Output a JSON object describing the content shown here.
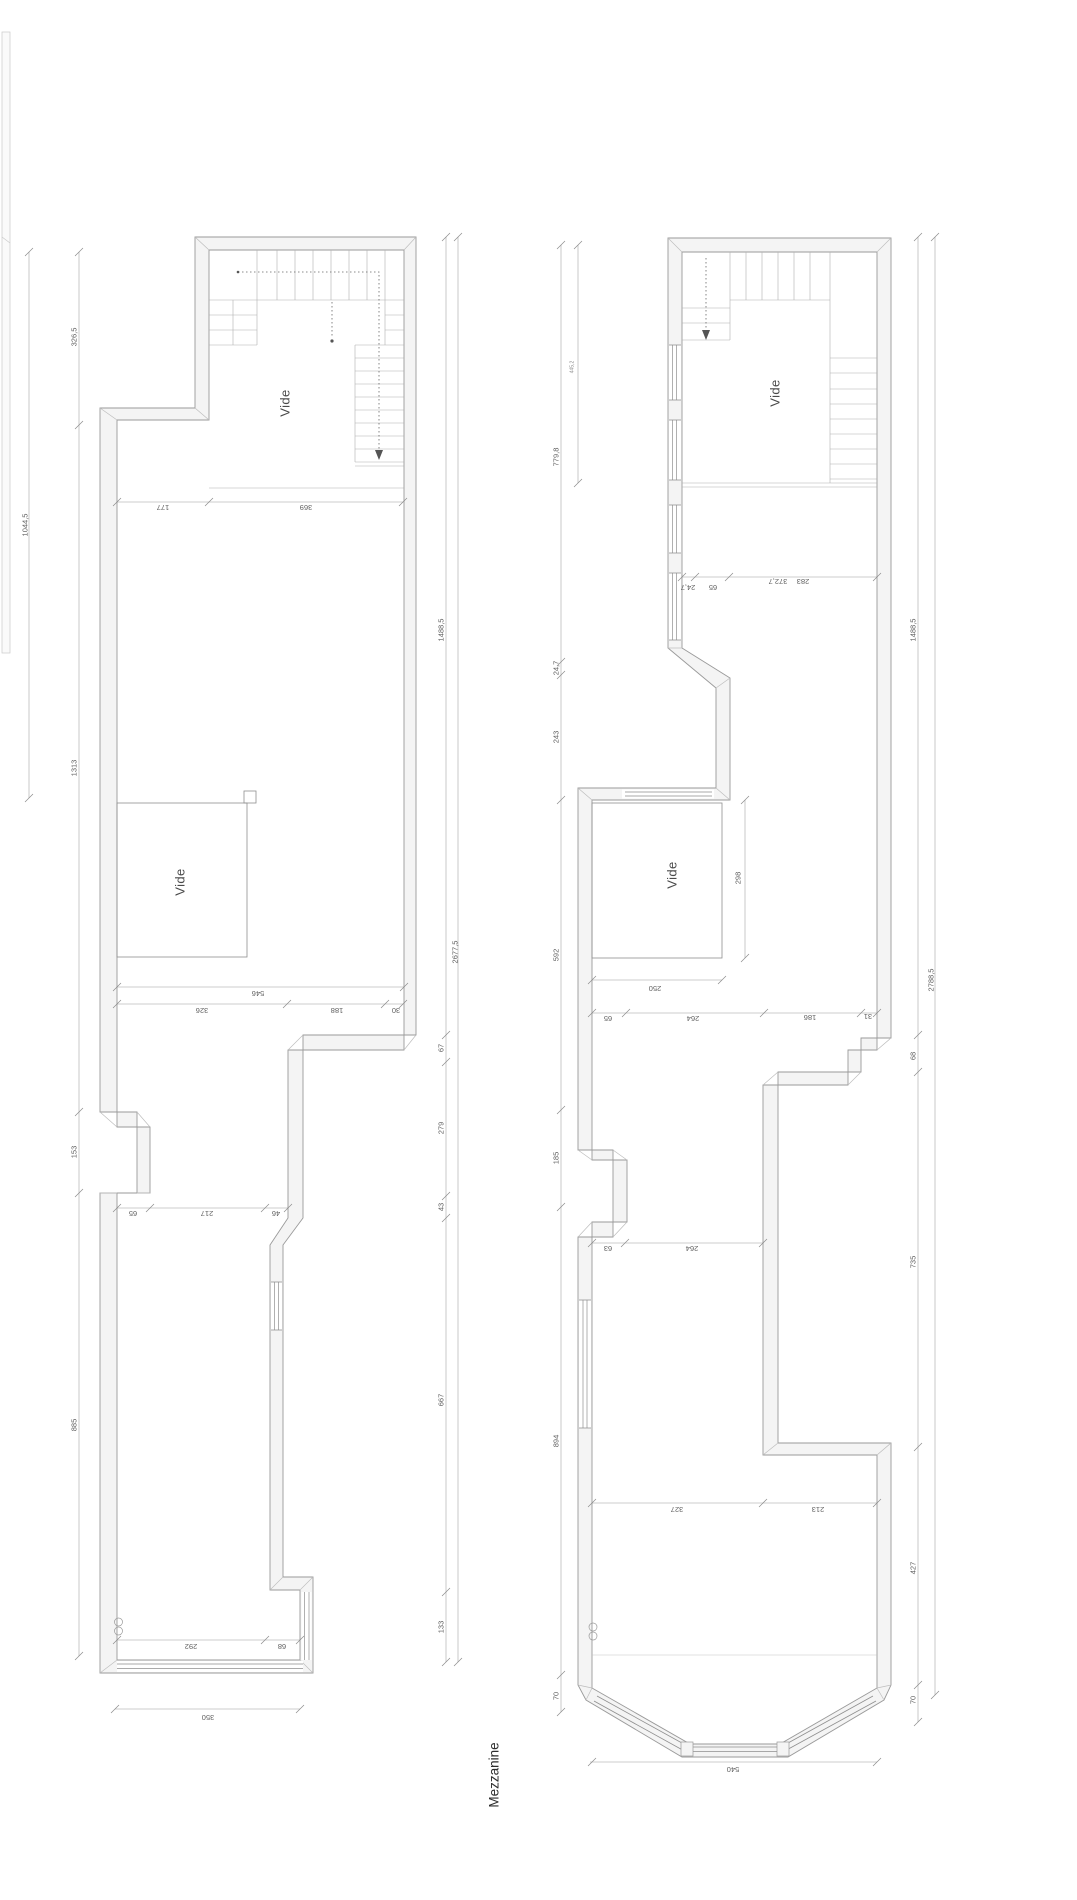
{
  "title": {
    "text": "Mezzanine",
    "x": 494,
    "y": 1775
  },
  "colors": {
    "background": "#ffffff",
    "wall_fill": "#f4f4f4",
    "wall_line": "#9a9a9a",
    "thin_line": "#b0b0b0",
    "dim_line": "#999999",
    "text": "#5f5f5f"
  },
  "plans": [
    {
      "name": "left-plan",
      "room_labels": [
        {
          "text": "Vide",
          "x": 285,
          "y": 403
        },
        {
          "text": "Vide",
          "x": 180,
          "y": 882
        }
      ],
      "dim_labels_vertical": [
        {
          "text": "326,5",
          "x": 74,
          "y": 337
        },
        {
          "text": "1044,5",
          "x": 25,
          "y": 525
        },
        {
          "text": "1313",
          "x": 74,
          "y": 768
        },
        {
          "text": "153",
          "x": 74,
          "y": 1152
        },
        {
          "text": "885",
          "x": 74,
          "y": 1425
        },
        {
          "text": "1488,5",
          "x": 441,
          "y": 630
        },
        {
          "text": "2677,5",
          "x": 455,
          "y": 952
        },
        {
          "text": "67",
          "x": 441,
          "y": 1048
        },
        {
          "text": "279",
          "x": 441,
          "y": 1128
        },
        {
          "text": "43",
          "x": 441,
          "y": 1207
        },
        {
          "text": "667",
          "x": 441,
          "y": 1400
        },
        {
          "text": "133",
          "x": 441,
          "y": 1627
        }
      ],
      "dim_labels_horizontal": [
        {
          "text": "177",
          "x": 163,
          "y": 507
        },
        {
          "text": "369",
          "x": 306,
          "y": 507
        },
        {
          "text": "546",
          "x": 258,
          "y": 993
        },
        {
          "text": "326",
          "x": 202,
          "y": 1010
        },
        {
          "text": "188",
          "x": 337,
          "y": 1010
        },
        {
          "text": "30",
          "x": 396,
          "y": 1010
        },
        {
          "text": "65",
          "x": 133,
          "y": 1213
        },
        {
          "text": "217",
          "x": 207,
          "y": 1213
        },
        {
          "text": "46",
          "x": 276,
          "y": 1213
        },
        {
          "text": "292",
          "x": 191,
          "y": 1646
        },
        {
          "text": "68",
          "x": 282,
          "y": 1646
        },
        {
          "text": "350",
          "x": 208,
          "y": 1717
        }
      ],
      "tiny_labels": []
    },
    {
      "name": "right-plan",
      "room_labels": [
        {
          "text": "Vide",
          "x": 775,
          "y": 393
        },
        {
          "text": "Vide",
          "x": 672,
          "y": 875
        }
      ],
      "dim_labels_vertical": [
        {
          "text": "779,8",
          "x": 556,
          "y": 457
        },
        {
          "text": "24,7",
          "x": 556,
          "y": 668
        },
        {
          "text": "243",
          "x": 556,
          "y": 737
        },
        {
          "text": "592",
          "x": 556,
          "y": 955
        },
        {
          "text": "185",
          "x": 556,
          "y": 1158
        },
        {
          "text": "894",
          "x": 556,
          "y": 1441
        },
        {
          "text": "70",
          "x": 556,
          "y": 1696
        },
        {
          "text": "1488,5",
          "x": 913,
          "y": 630
        },
        {
          "text": "2788,5",
          "x": 931,
          "y": 980
        },
        {
          "text": "68",
          "x": 913,
          "y": 1056
        },
        {
          "text": "735",
          "x": 913,
          "y": 1262
        },
        {
          "text": "427",
          "x": 913,
          "y": 1568
        },
        {
          "text": "70",
          "x": 913,
          "y": 1700
        },
        {
          "text": "298",
          "x": 738,
          "y": 878
        }
      ],
      "dim_labels_horizontal": [
        {
          "text": "24,7",
          "x": 688,
          "y": 587
        },
        {
          "text": "65",
          "x": 713,
          "y": 587
        },
        {
          "text": "372,7",
          "x": 778,
          "y": 581
        },
        {
          "text": "283",
          "x": 803,
          "y": 581
        },
        {
          "text": "250",
          "x": 655,
          "y": 988
        },
        {
          "text": "65",
          "x": 608,
          "y": 1018
        },
        {
          "text": "264",
          "x": 693,
          "y": 1018
        },
        {
          "text": "186",
          "x": 810,
          "y": 1017
        },
        {
          "text": "31",
          "x": 868,
          "y": 1016
        },
        {
          "text": "63",
          "x": 608,
          "y": 1248
        },
        {
          "text": "264",
          "x": 692,
          "y": 1248
        },
        {
          "text": "327",
          "x": 677,
          "y": 1509
        },
        {
          "text": "213",
          "x": 818,
          "y": 1509
        },
        {
          "text": "540",
          "x": 733,
          "y": 1769
        }
      ],
      "tiny_labels": [
        {
          "text": "445,2",
          "x": 573,
          "y": 367
        }
      ]
    }
  ]
}
